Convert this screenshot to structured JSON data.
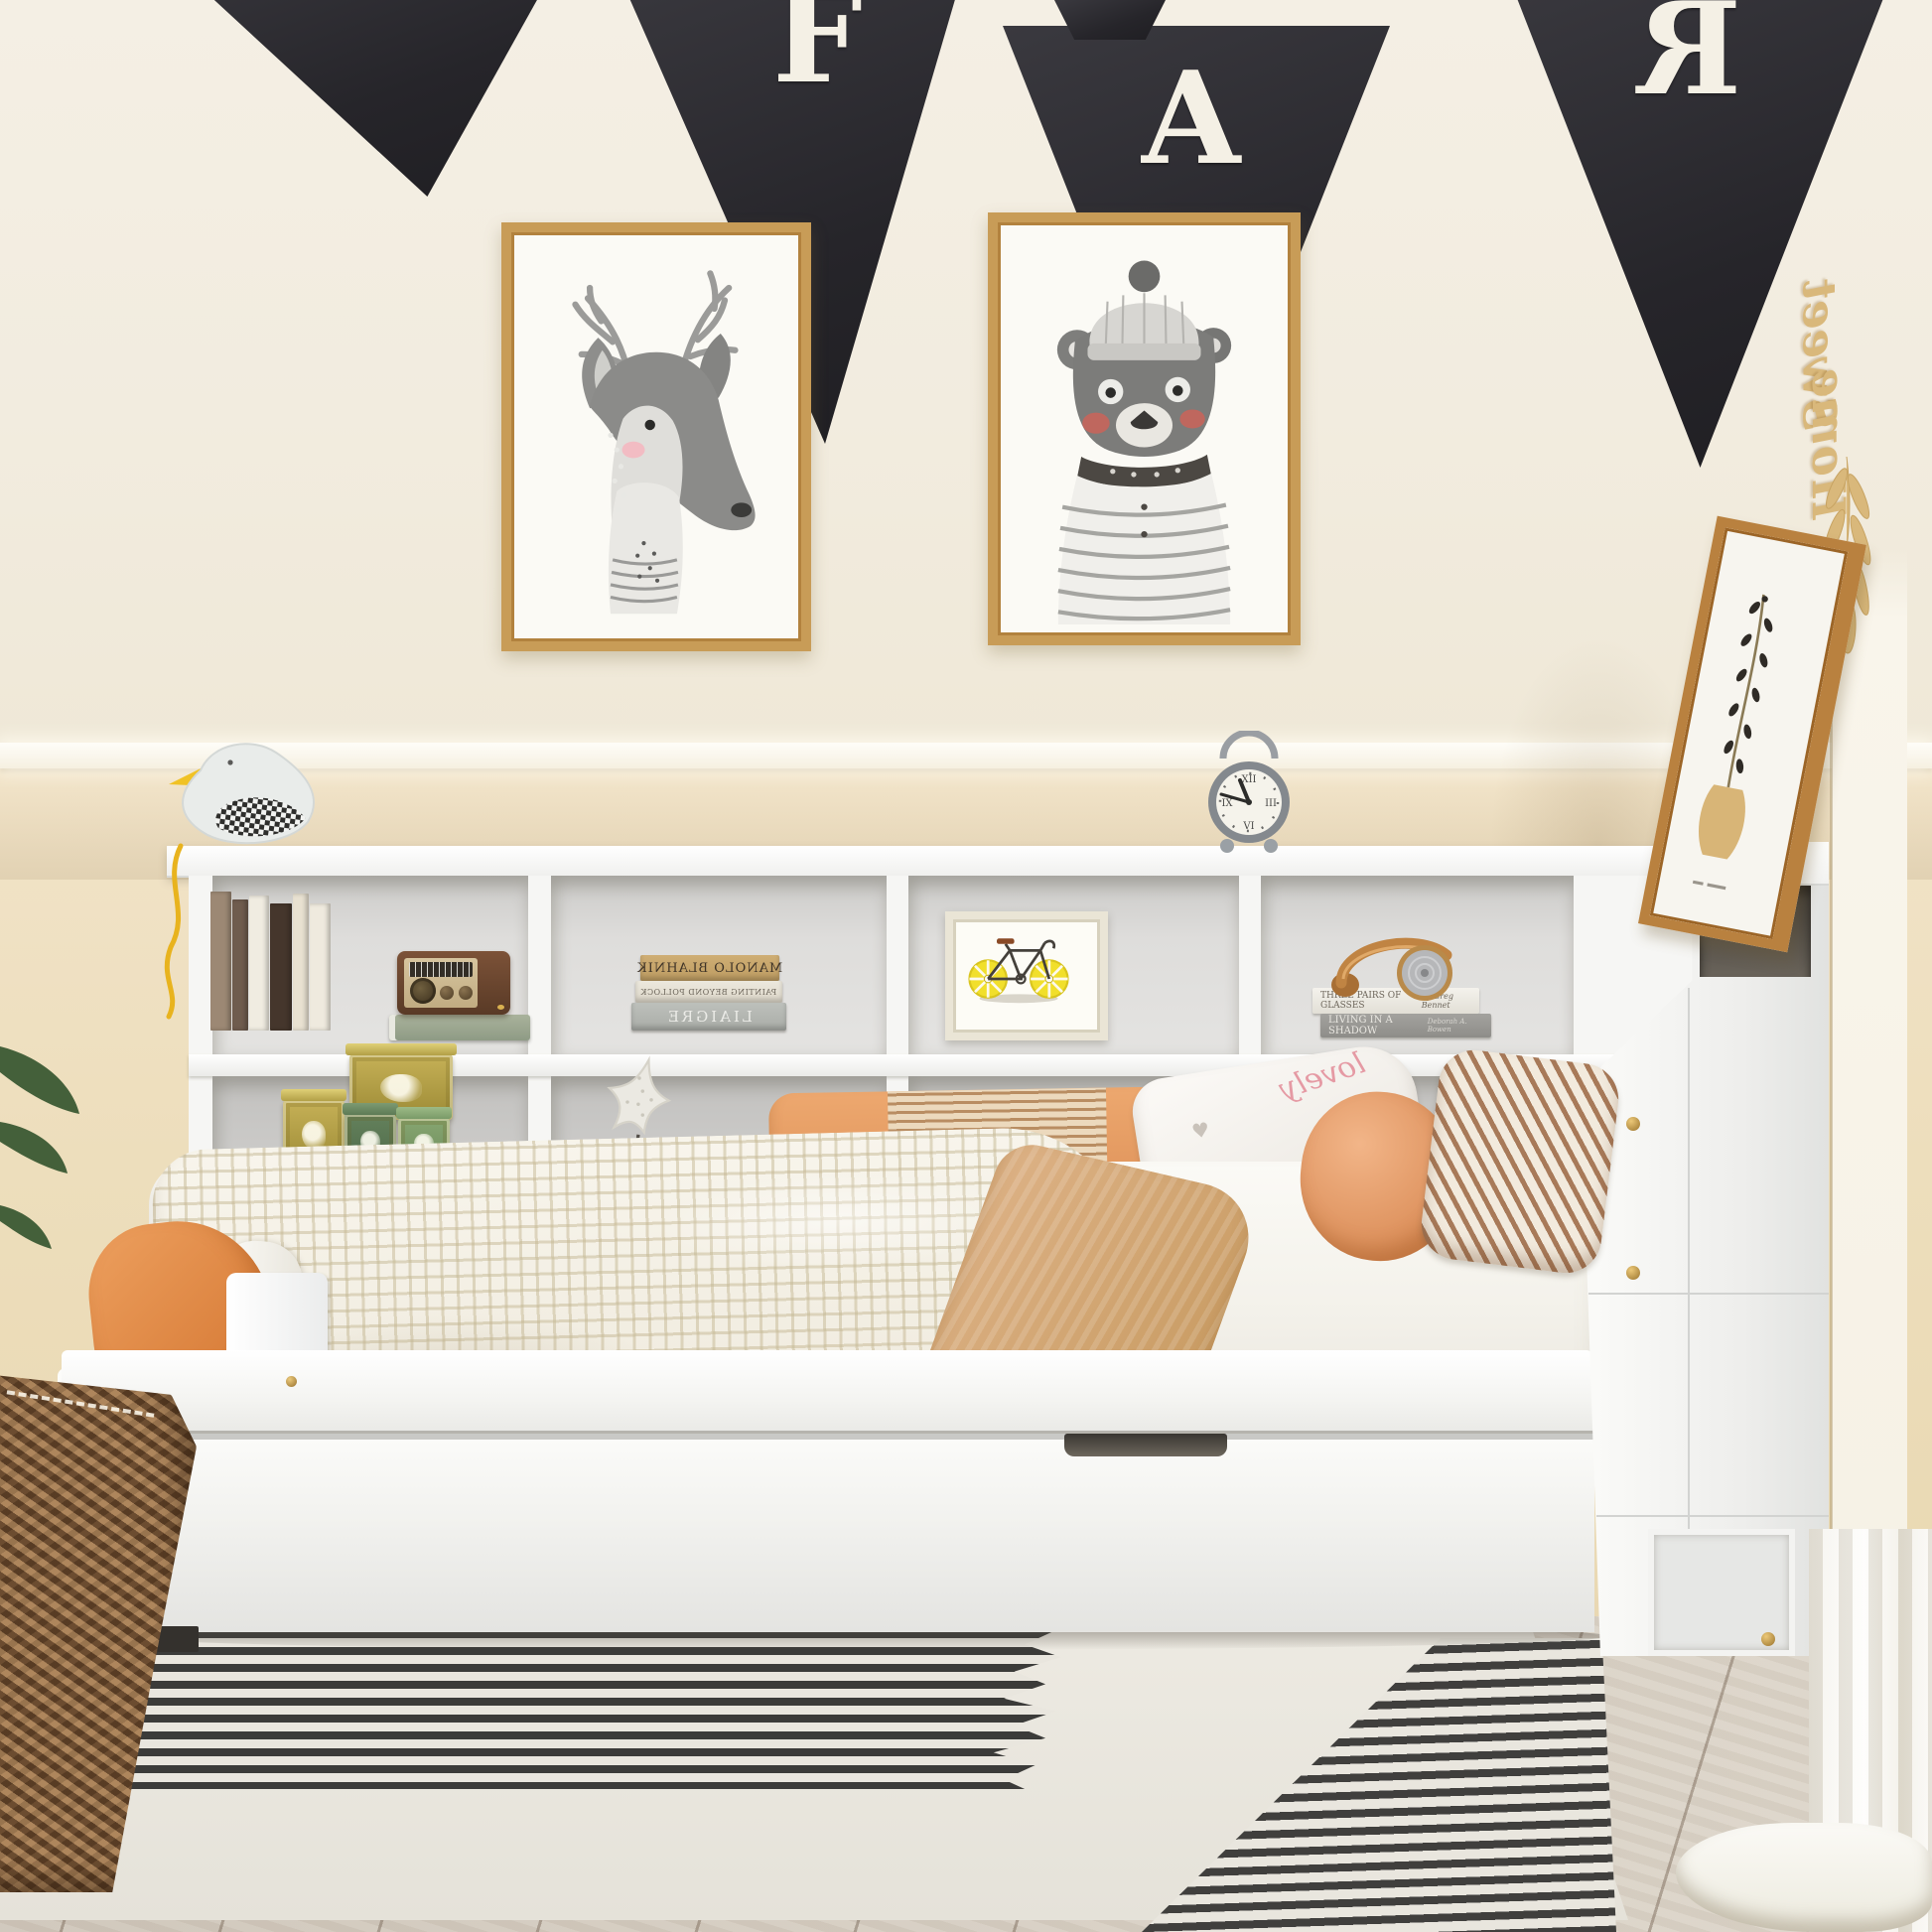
{
  "scene": {
    "title": "Kids bedroom with white daybed, bookcase headboard and trundle drawer"
  },
  "banner": {
    "flag_color": "#2d2c31",
    "letter_color": "#f4f0e5",
    "letters": [
      {
        "glyph": "F",
        "mirrored": false
      },
      {
        "glyph": "A",
        "mirrored": false
      },
      {
        "glyph": "R",
        "mirrored": true
      }
    ]
  },
  "gallery": {
    "left_art": "watercolor deer with antlers and striped collar",
    "right_art": "watercolor bear wearing knit beanie and striped pajama top",
    "frame_color": "#c89c57"
  },
  "wall_script": {
    "word_top": "Sweet",
    "word_bottom": "Home",
    "color": "#d9b87b"
  },
  "clock": {
    "time": "10:50",
    "numeral_12": "XII",
    "numeral_3": "III",
    "numeral_6": "VI",
    "numeral_9": "IX"
  },
  "shelf": {
    "stacked_books": [
      {
        "title": "MANOLO BLAHNIK"
      },
      {
        "title": "PAINTING BEYOND POLLOCK"
      },
      {
        "title": "LIAIGRE"
      }
    ],
    "flat_books": [
      {
        "title": "THREE PAIRS OF GLASSES",
        "author": "by Greg Bennet"
      },
      {
        "title": "LIVING IN A SHADOW",
        "author": "Deborah A. Bowen"
      }
    ],
    "objects": [
      "vintage radio",
      "tea tins",
      "starfish",
      "lemon-wheel bicycle print",
      "headphones",
      "seagull figurine",
      "alarm clock"
    ]
  },
  "pillow_script": "lovely",
  "palette": {
    "wall_upper": "#f2ecdf",
    "wall_lower": "#eedfc2",
    "furniture_white": "#f7f7f5",
    "accent_orange": "#e78e52",
    "throw_camel": "#d0a571",
    "rug_stripe": "#3b3b39",
    "floor_wood": "#d5ccc0",
    "basket_brown": "#8d6847",
    "headphone_tan": "#c08443"
  }
}
